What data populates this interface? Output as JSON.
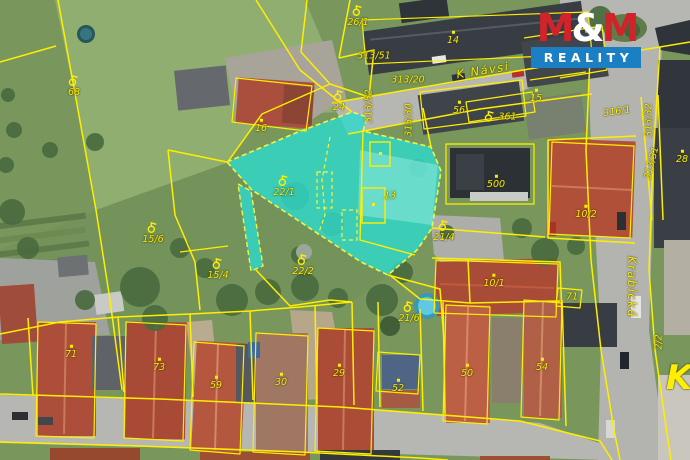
{
  "branding": {
    "m1": "M",
    "amp": "&",
    "m2": "M",
    "reality": "REALITY",
    "colors": {
      "logo_red": "#d2232a",
      "logo_blue": "#1b7fc4",
      "logo_white": "#ffffff"
    }
  },
  "map": {
    "type": "cadastral-aerial",
    "colors": {
      "cadastral_line": "#ffee00",
      "highlight_fill": "#2ed9cc"
    },
    "labels": [
      {
        "text": "68",
        "x": 74,
        "y": 86,
        "sym": "garden"
      },
      {
        "text": "15/6",
        "x": 153,
        "y": 233,
        "sym": "garden"
      },
      {
        "text": "15/4",
        "x": 218,
        "y": 269,
        "sym": "garden"
      },
      {
        "text": "26/1",
        "x": 358,
        "y": 16,
        "sym": "garden"
      },
      {
        "text": "24",
        "x": 339,
        "y": 101,
        "sym": "garden"
      },
      {
        "text": "16",
        "x": 261,
        "y": 126,
        "sym": "dot"
      },
      {
        "text": "313/51",
        "x": 374,
        "y": 56
      },
      {
        "text": "313/20",
        "x": 408,
        "y": 80
      },
      {
        "text": "14",
        "x": 453,
        "y": 38,
        "sym": "dot"
      },
      {
        "text": "56",
        "x": 459,
        "y": 108,
        "sym": "dot"
      },
      {
        "text": "361",
        "x": 500,
        "y": 117,
        "sym": "garden",
        "cls": "row"
      },
      {
        "text": "313/52",
        "x": 369,
        "y": 106,
        "rot": -90
      },
      {
        "text": "313/30",
        "x": 409,
        "y": 120,
        "rot": -90
      },
      {
        "text": "15",
        "x": 536,
        "y": 96,
        "sym": "dot"
      },
      {
        "text": "316/1",
        "x": 617,
        "y": 112,
        "rot": -8
      },
      {
        "text": "313/32",
        "x": 649,
        "y": 120,
        "rot": -90
      },
      {
        "text": "313/31",
        "x": 652,
        "y": 163,
        "rot": -75
      },
      {
        "text": "28",
        "x": 682,
        "y": 157,
        "sym": "dot"
      },
      {
        "text": "500",
        "x": 496,
        "y": 182,
        "sym": "dot"
      },
      {
        "text": "10/2",
        "x": 586,
        "y": 212,
        "sym": "dot"
      },
      {
        "text": "21/4",
        "x": 444,
        "y": 231,
        "sym": "garden"
      },
      {
        "text": "22/1",
        "x": 284,
        "y": 186,
        "sym": "garden"
      },
      {
        "text": "13",
        "x": 390,
        "y": 196
      },
      {
        "text": "22/2",
        "x": 303,
        "y": 265,
        "sym": "garden"
      },
      {
        "text": "21/6",
        "x": 409,
        "y": 312,
        "sym": "garden"
      },
      {
        "text": "10/1",
        "x": 494,
        "y": 281,
        "sym": "dot"
      },
      {
        "text": "71",
        "x": 572,
        "y": 297
      },
      {
        "text": "50",
        "x": 467,
        "y": 371,
        "sym": "dot"
      },
      {
        "text": "54",
        "x": 542,
        "y": 365,
        "sym": "dot"
      },
      {
        "text": "71",
        "x": 71,
        "y": 352,
        "sym": "dot"
      },
      {
        "text": "73",
        "x": 159,
        "y": 365,
        "sym": "dot"
      },
      {
        "text": "59",
        "x": 216,
        "y": 383,
        "sym": "dot"
      },
      {
        "text": "30",
        "x": 281,
        "y": 380,
        "sym": "dot"
      },
      {
        "text": "29",
        "x": 339,
        "y": 371,
        "sym": "dot"
      },
      {
        "text": "52",
        "x": 398,
        "y": 386,
        "sym": "dot"
      },
      {
        "text": "2/2",
        "x": 659,
        "y": 342,
        "rot": -90
      },
      {
        "text": "K Návsi",
        "x": 483,
        "y": 71,
        "rot": -9,
        "cls": "street"
      },
      {
        "text": "Krabická",
        "x": 631,
        "y": 287,
        "rot": 90,
        "cls": "street"
      },
      {
        "text": "K",
        "x": 679,
        "y": 378,
        "cls": "big"
      }
    ]
  }
}
